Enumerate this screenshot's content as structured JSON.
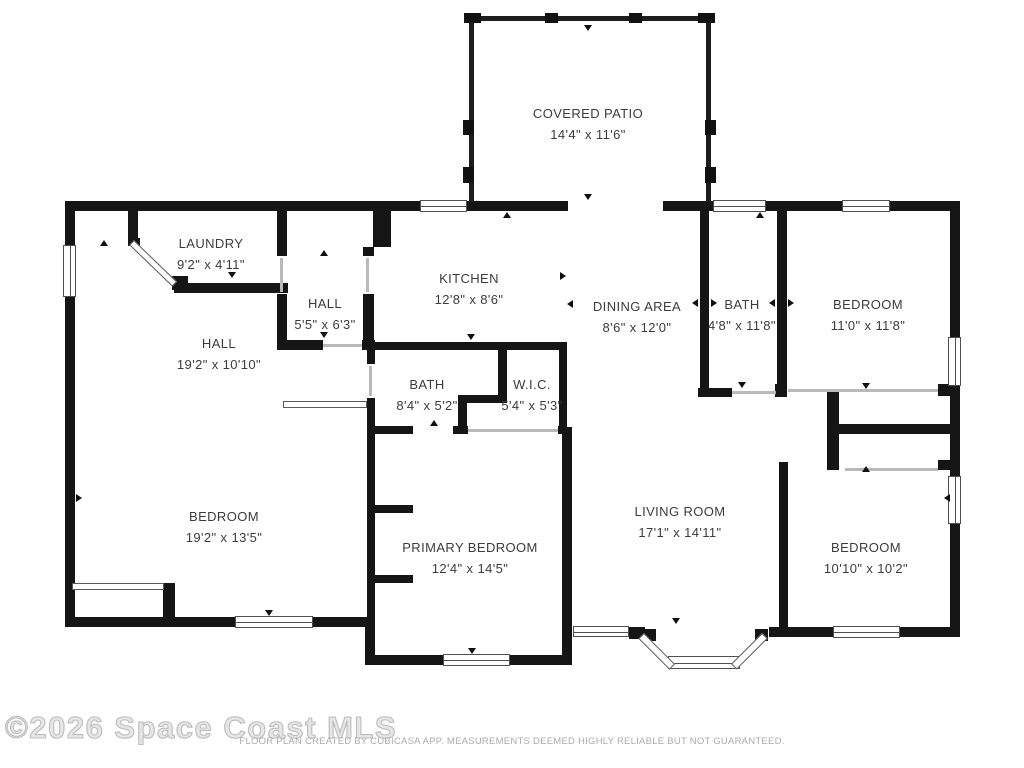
{
  "rooms": [
    {
      "name": "COVERED PATIO",
      "dims": "14'4\" x 11'6\""
    },
    {
      "name": "LAUNDRY",
      "dims": "9'2\" x 4'11\""
    },
    {
      "name": "HALL",
      "dims": "5'5\" x 6'3\""
    },
    {
      "name": "KITCHEN",
      "dims": "12'8\" x 8'6\""
    },
    {
      "name": "DINING AREA",
      "dims": "8'6\" x 12'0\""
    },
    {
      "name": "BATH",
      "dims": "4'8\" x 11'8\""
    },
    {
      "name": "BEDROOM",
      "dims": "11'0\" x 11'8\""
    },
    {
      "name": "HALL",
      "dims": "19'2\" x 10'10\""
    },
    {
      "name": "BATH",
      "dims": "8'4\" x 5'2\""
    },
    {
      "name": "W.I.C.",
      "dims": "5'4\" x 5'3\""
    },
    {
      "name": "BEDROOM",
      "dims": "19'2\" x 13'5\""
    },
    {
      "name": "PRIMARY BEDROOM",
      "dims": "12'4\" x 14'5\""
    },
    {
      "name": "LIVING ROOM",
      "dims": "17'1\" x 14'11\""
    },
    {
      "name": "BEDROOM",
      "dims": "10'10\" x 10'2\""
    }
  ],
  "watermark": "©2026 Space Coast MLS",
  "footer": "FLOOR PLAN CREATED BY CUBICASA APP. MEASUREMENTS DEEMED HIGHLY RELIABLE BUT NOT GUARANTEED.",
  "colors": {
    "wall": "#151515",
    "label": "#3c3c3c",
    "watermark": "#bdbdbd",
    "footer": "#ababab"
  }
}
